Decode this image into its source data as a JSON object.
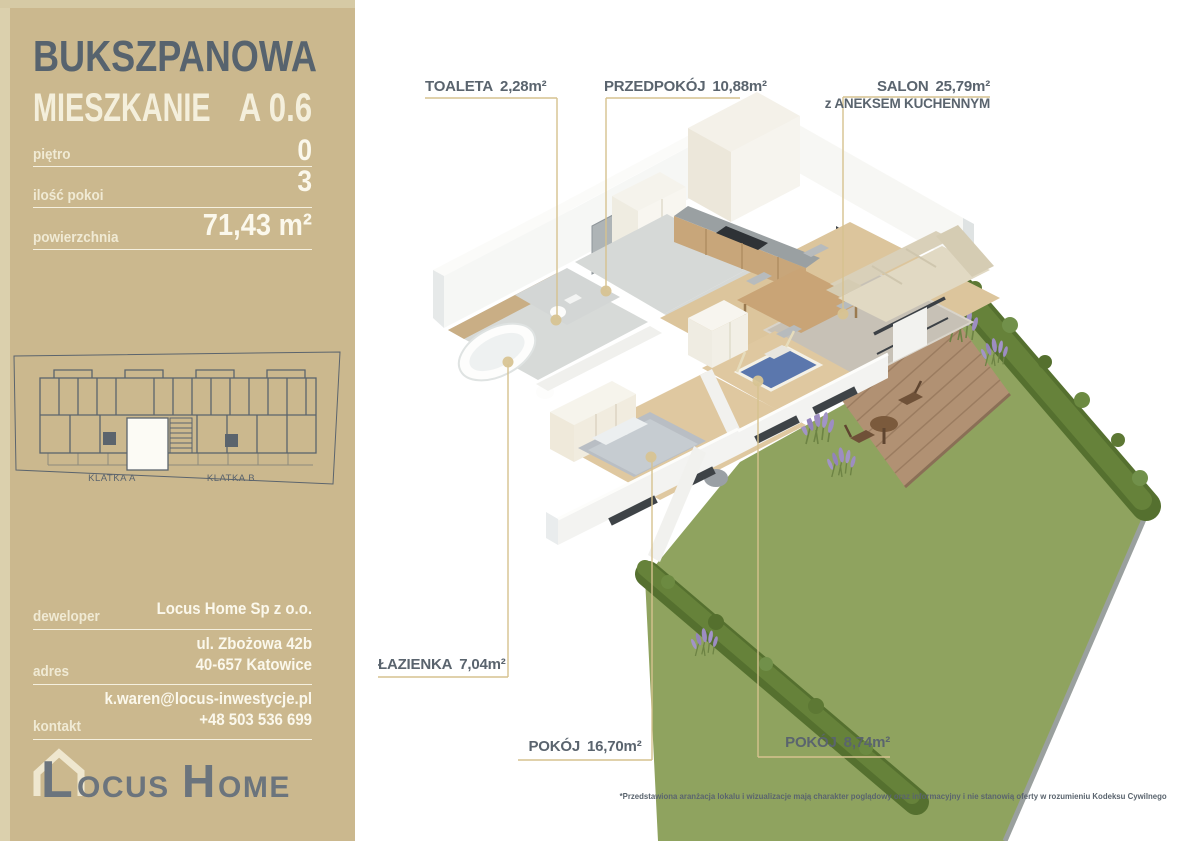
{
  "colors": {
    "sidebar_bg": "#cbb88e",
    "sidebar_edge": "#dbd0ad",
    "slate_text": "#5a646e",
    "cream_text": "#f4efdc",
    "leader_line": "#d6c28f",
    "lawn_green": "#8fa35f",
    "hedge_green": "#5d7834",
    "deck_wood": "#b19173",
    "wood_floor": "#dfc8a0",
    "tile_floor": "#d6d9d7"
  },
  "sidebar": {
    "project_name": "BUKSZPANOWA",
    "unit_label": "MIESZKANIE",
    "unit_number": "A 0.6",
    "specs": [
      {
        "label": "piętro",
        "value": "0"
      },
      {
        "label": "ilość pokoi",
        "value": "3"
      },
      {
        "label": "powierzchnia",
        "value": "71,43 m²"
      }
    ],
    "minimap": {
      "labels": [
        "KLATKA A",
        "KLATKA B"
      ]
    },
    "contact": [
      {
        "label": "deweloper",
        "lines": [
          "Locus Home Sp z o.o."
        ]
      },
      {
        "label": "adres",
        "lines": [
          "ul. Zbożowa 42b",
          "40-657 Katowice"
        ]
      },
      {
        "label": "kontakt",
        "lines": [
          "k.waren@locus-inwestycje.pl",
          "+48 503 536 699"
        ]
      }
    ],
    "logo": {
      "word1_initial": "L",
      "word1_rest": "OCUS",
      "word2_initial": "H",
      "word2_rest": "OME"
    }
  },
  "floorplan": {
    "labels": [
      {
        "id": "toaleta",
        "name": "TOALETA",
        "area": "2,28m²"
      },
      {
        "id": "przedpokoj",
        "name": "PRZEDPOKÓJ",
        "area": "10,88m²"
      },
      {
        "id": "salon",
        "name": "SALON",
        "area": "25,79m²",
        "sub": "z ANEKSEM KUCHENNYM"
      },
      {
        "id": "lazienka",
        "name": "ŁAZIENKA",
        "area": "7,04m²"
      },
      {
        "id": "pokoj1",
        "name": "POKÓJ",
        "area": "16,70m²"
      },
      {
        "id": "pokoj2",
        "name": "POKÓJ",
        "area": "8,74m²"
      }
    ],
    "disclaimer": "*Przedstawiona aranżacja lokalu i wizualizacje mają charakter poglądowy oraz informacyjny i nie stanowią oferty w rozumieniu Kodeksu Cywilnego"
  }
}
